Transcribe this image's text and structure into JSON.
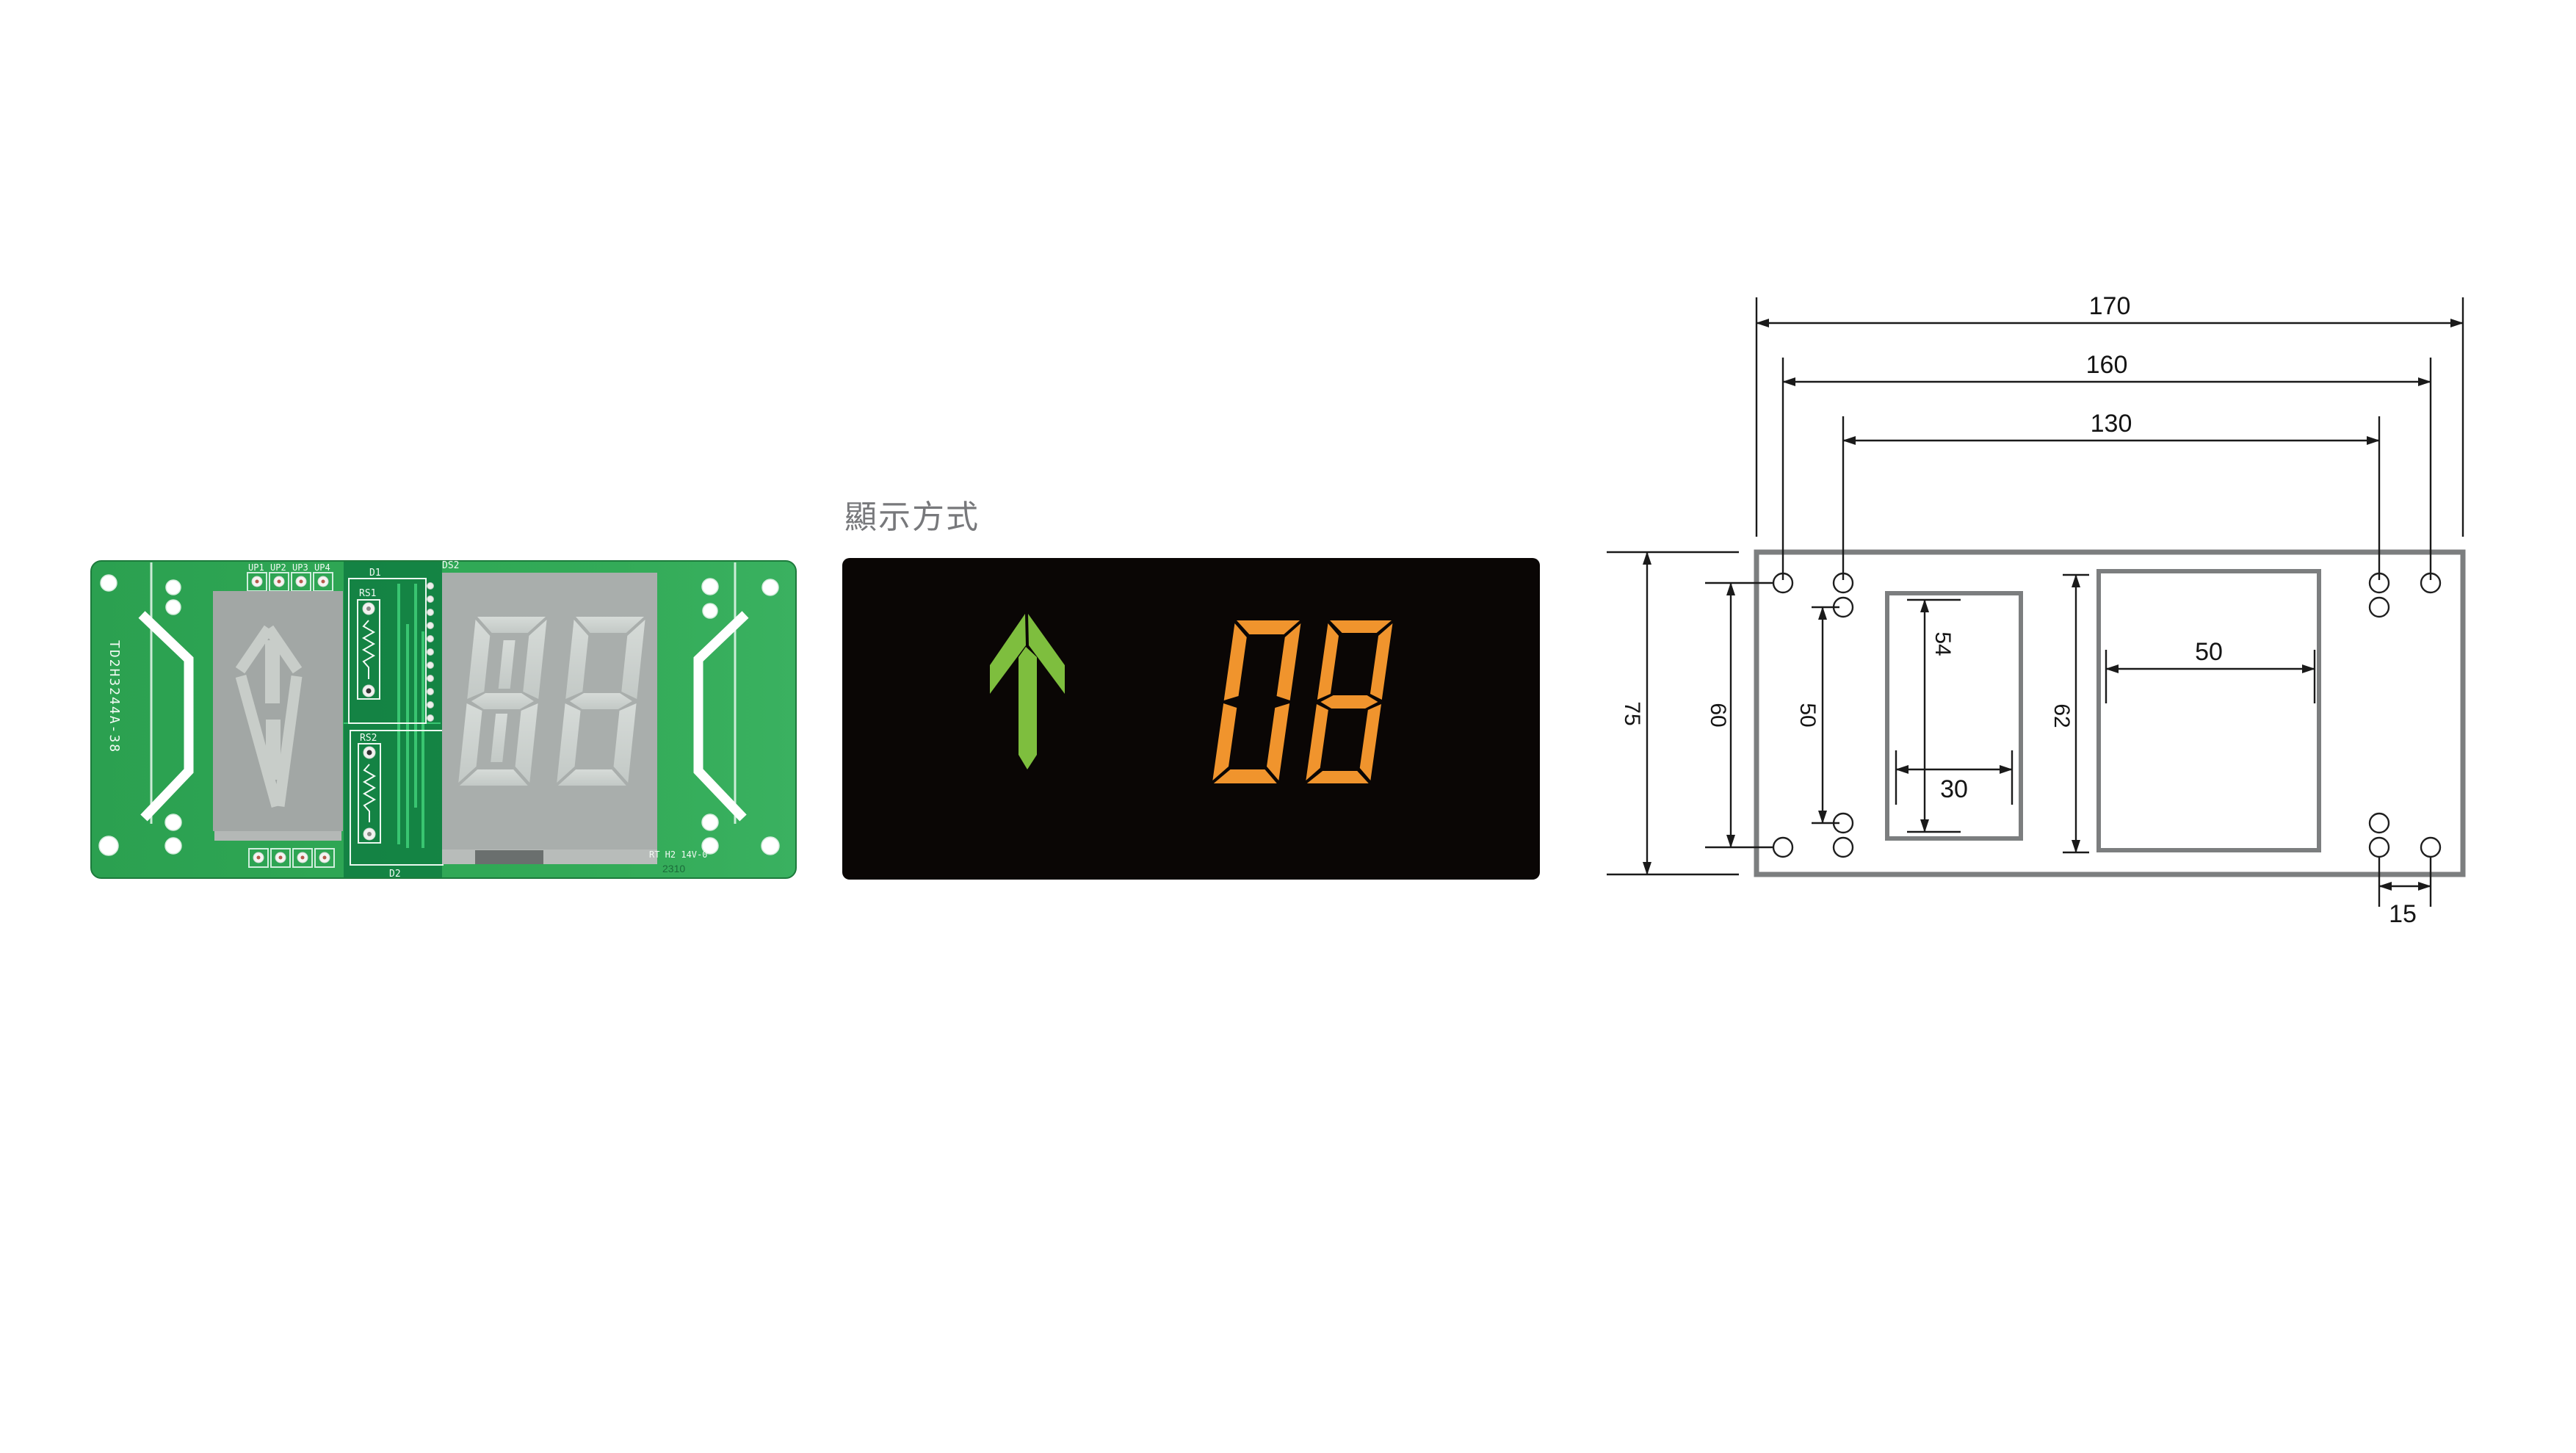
{
  "display": {
    "section_title": "顯示方式",
    "direction_arrow": "up",
    "floor_value": "08",
    "colors": {
      "background": "#0a0605",
      "arrow_green": "#7ebe3e",
      "digit_orange": "#f0942d"
    }
  },
  "pcb": {
    "part_number_vertical": "TD2H3244A-38",
    "digit_display": "88",
    "connector_labels_top": {
      "up1": "UP1",
      "up2": "UP2",
      "up3": "UP3",
      "up4": "UP4"
    },
    "silkscreen": {
      "d1": "D1",
      "rs1": "RS1",
      "rs2": "RS2",
      "d2": "D2",
      "ds2": "DS2"
    },
    "marking_right": "RT H2 14V-0",
    "marking_date": "2310",
    "colors": {
      "board_green": "#2fa855",
      "module_gray": "#a2a7a5",
      "segment_gray": "#ced3d0"
    }
  },
  "drawing": {
    "dims": {
      "overall_width": "170",
      "hole_span_outer": "160",
      "hole_span_inner": "130",
      "overall_height": "75",
      "hole_rows_outer": "60",
      "hole_rows_inner": "50",
      "small_window_height": "54",
      "small_window_width": "30",
      "large_window_height": "62",
      "large_window_width": "50",
      "bottom_hole_gap": "15"
    }
  }
}
